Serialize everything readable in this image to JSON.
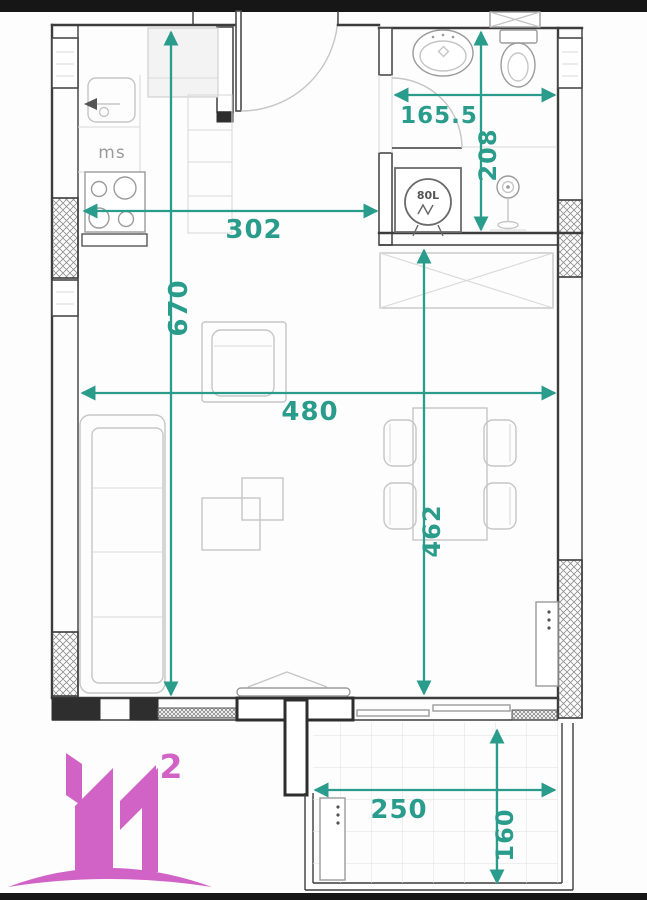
{
  "floorplan": {
    "labels": {
      "washing_machine": "ms",
      "boiler": "80L"
    },
    "dimensions": {
      "kitchen_width": "302",
      "living_length": "670",
      "bathroom_width": "165.5",
      "bathroom_length": "208",
      "living_width": "480",
      "dining_length": "462",
      "balcony_width": "250",
      "balcony_depth": "160"
    },
    "colors": {
      "dimension_teal": "#2a9c8c",
      "wall_dark": "#3c3c3c",
      "furniture_gray": "#c6c6c6",
      "logo_pink": "#d163c7"
    }
  },
  "logo": {
    "superscript": "2"
  }
}
